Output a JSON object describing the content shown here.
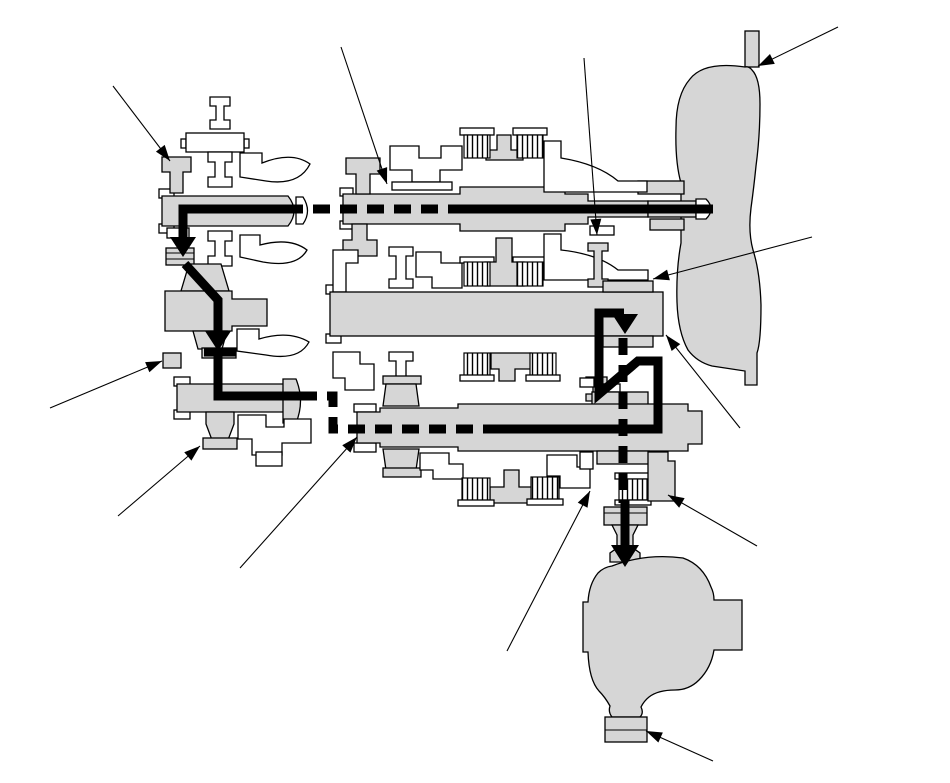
{
  "diagram": {
    "canvas": {
      "width": 950,
      "height": 783
    },
    "colors": {
      "background": "#ffffff",
      "part_fill": "#d6d6d6",
      "white_part": "#ffffff",
      "outline": "#000000",
      "flow": "#000000"
    },
    "flow_path": {
      "stroke_width": 9,
      "dash": [
        17,
        10
      ],
      "segments": [
        {
          "style": "solid",
          "points": [
            [
              713,
              209
            ],
            [
              465,
              209
            ]
          ]
        },
        {
          "style": "dashed",
          "points": [
            [
              465,
              209
            ],
            [
              297,
              209
            ]
          ]
        },
        {
          "style": "solid",
          "points": [
            [
              302,
              209
            ],
            [
              183,
              209
            ],
            [
              183,
              240
            ]
          ]
        },
        {
          "style": "solid",
          "points": [
            [
              185,
              264
            ],
            [
              218,
              300
            ],
            [
              218,
              333
            ]
          ]
        },
        {
          "style": "solid",
          "points": [
            [
              204,
              352
            ],
            [
              236,
              352
            ]
          ]
        },
        {
          "style": "solid",
          "points": [
            [
              218,
              352
            ],
            [
              218,
              396
            ],
            [
              300,
              396
            ]
          ]
        },
        {
          "style": "dashed",
          "points": [
            [
              300,
              396
            ],
            [
              333,
              396
            ],
            [
              333,
              429
            ],
            [
              487,
              429
            ]
          ]
        },
        {
          "style": "solid",
          "points": [
            [
              483,
              429
            ],
            [
              658,
              429
            ],
            [
              658,
              361
            ],
            [
              638,
              361
            ],
            [
              599,
              394
            ],
            [
              599,
              313
            ],
            [
              624,
              313
            ]
          ]
        },
        {
          "style": "dashed",
          "points": [
            [
              623,
              338
            ],
            [
              623,
              503
            ]
          ]
        },
        {
          "style": "solid",
          "points": [
            [
              625,
              500
            ],
            [
              625,
              546
            ]
          ]
        }
      ],
      "arrowheads": [
        {
          "tip": [
            183,
            257
          ],
          "length": 20,
          "half_width": 13
        },
        {
          "tip": [
            218,
            351
          ],
          "length": 20,
          "half_width": 13
        },
        {
          "tip": [
            625,
            334
          ],
          "length": 20,
          "half_width": 13
        },
        {
          "tip": [
            625,
            567
          ],
          "length": 22,
          "half_width": 14
        }
      ]
    },
    "callouts": [
      {
        "from": [
          113,
          86
        ],
        "to": [
          170,
          161
        ]
      },
      {
        "from": [
          341,
          47
        ],
        "to": [
          387,
          184
        ]
      },
      {
        "from": [
          584,
          58
        ],
        "to": [
          597,
          235
        ]
      },
      {
        "from": [
          838,
          27
        ],
        "to": [
          758,
          66
        ]
      },
      {
        "from": [
          812,
          237
        ],
        "to": [
          653,
          279
        ]
      },
      {
        "from": [
          740,
          428
        ],
        "to": [
          666,
          335
        ]
      },
      {
        "from": [
          50,
          408
        ],
        "to": [
          162,
          361
        ]
      },
      {
        "from": [
          118,
          516
        ],
        "to": [
          200,
          446
        ]
      },
      {
        "from": [
          240,
          568
        ],
        "to": [
          357,
          437
        ]
      },
      {
        "from": [
          507,
          651
        ],
        "to": [
          590,
          491
        ]
      },
      {
        "from": [
          757,
          546
        ],
        "to": [
          668,
          495
        ]
      },
      {
        "from": [
          713,
          761
        ],
        "to": [
          646,
          731
        ]
      }
    ],
    "callout_arrowhead": {
      "length": 16,
      "half_width": 5.5
    }
  }
}
